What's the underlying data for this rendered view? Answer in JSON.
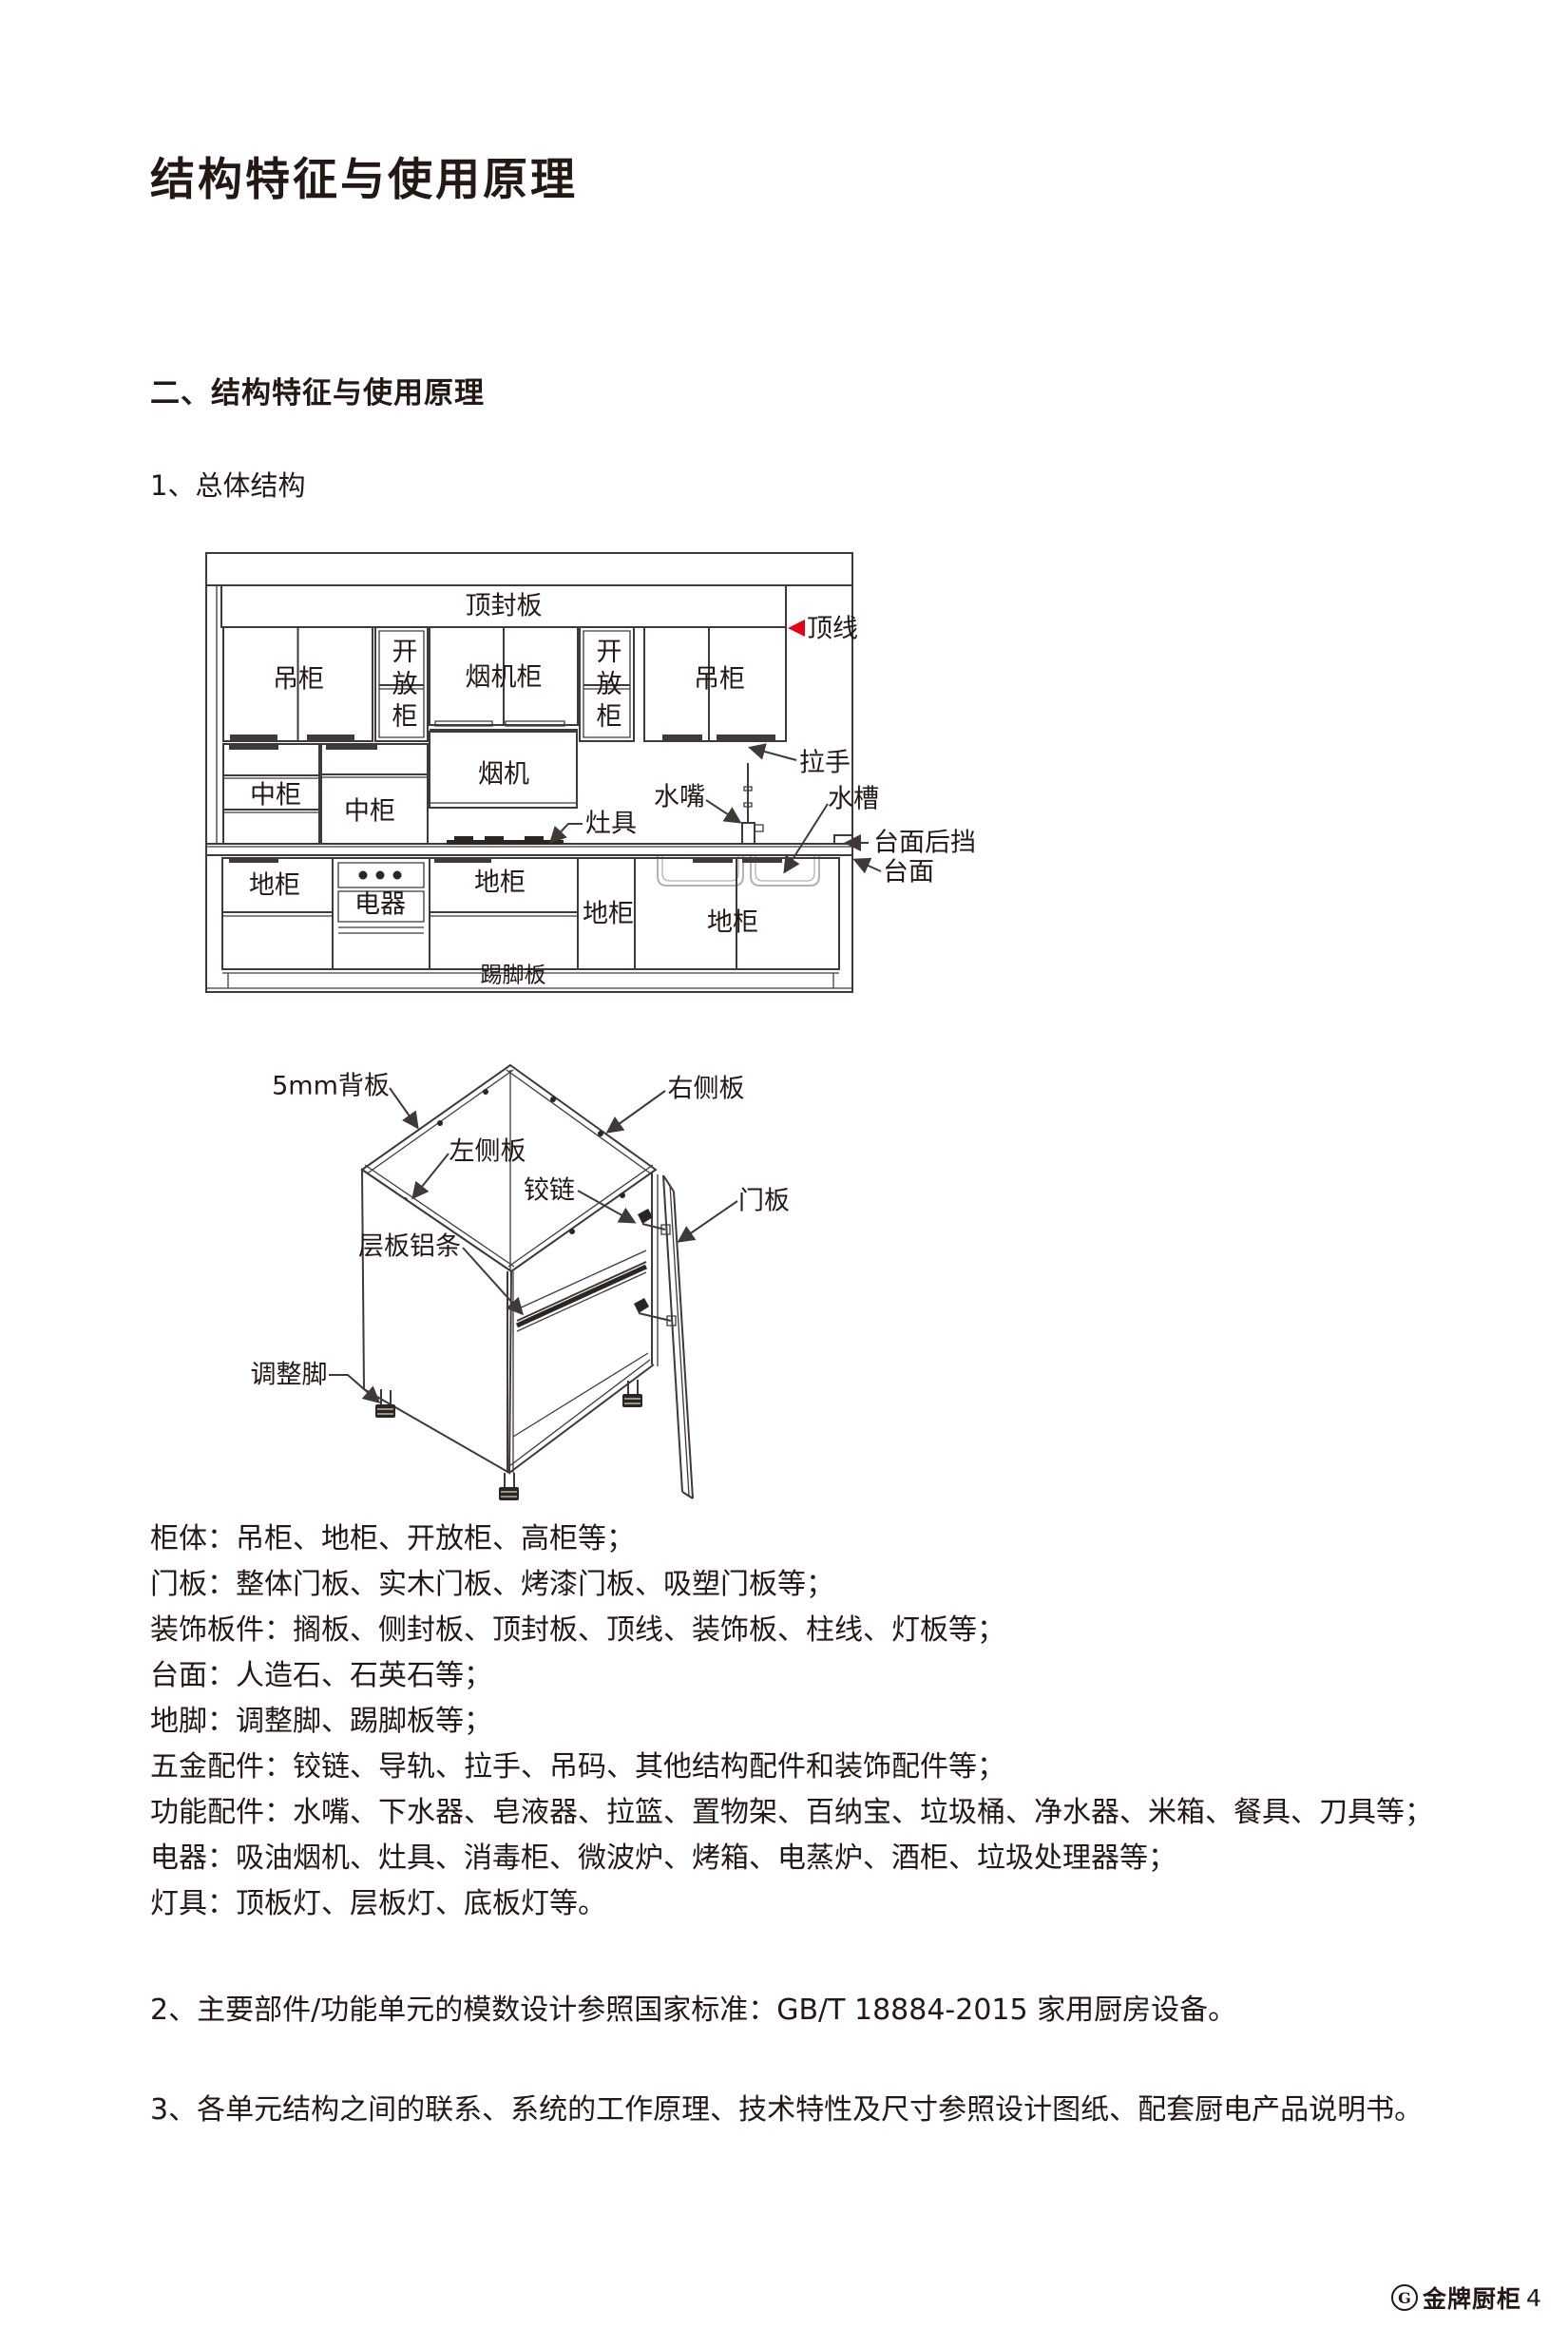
{
  "page": {
    "title": "结构特征与使用原理",
    "section_heading": "二、结构特征与使用原理",
    "subsection_heading": "1、总体结构"
  },
  "diagram_overall": {
    "labels": {
      "top_seal_board": "顶封板",
      "crown_line": "顶线",
      "wall_cabinet": "吊柜",
      "open_cabinet": "开放柜",
      "hood_cabinet": "烟机柜",
      "handle": "拉手",
      "hood": "烟机",
      "mid_cabinet": "中柜",
      "stove": "灶具",
      "faucet": "水嘴",
      "sink": "水槽",
      "countertop_backsplash": "台面后挡",
      "countertop": "台面",
      "base_cabinet": "地柜",
      "appliance": "电器",
      "kick_board": "踢脚板"
    }
  },
  "diagram_unit": {
    "labels": {
      "back_panel": "5mm背板",
      "right_side_panel": "右侧板",
      "left_side_panel": "左侧板",
      "hinge": "铰链",
      "door_panel": "门板",
      "shelf_aluminum_strip": "层板铝条",
      "adjustable_foot": "调整脚"
    }
  },
  "component_list": [
    "柜体：吊柜、地柜、开放柜、高柜等；",
    "门板：整体门板、实木门板、烤漆门板、吸塑门板等；",
    "装饰板件：搁板、侧封板、顶封板、顶线、装饰板、柱线、灯板等；",
    "台面：人造石、石英石等；",
    "地脚：调整脚、踢脚板等；",
    "五金配件：铰链、导轨、拉手、吊码、其他结构配件和装饰配件等；",
    "功能配件：水嘴、下水器、皂液器、拉篮、置物架、百纳宝、垃圾桶、净水器、米箱、餐具、刀具等；",
    "电器：吸油烟机、灶具、消毒柜、微波炉、烤箱、电蒸炉、酒柜、垃圾处理器等；",
    "灯具：顶板灯、层板灯、底板灯等。"
  ],
  "notes": [
    "2、主要部件/功能单元的模数设计参照国家标准：GB/T 18884-2015 家用厨房设备。",
    "3、各单元结构之间的联系、系统的工作原理、技术特性及尺寸参照设计图纸、配套厨电产品说明书。"
  ],
  "footer": {
    "logo_letter": "G",
    "brand": "金牌厨柜",
    "page_number": "4"
  },
  "colors": {
    "text": "#231815",
    "line": "#3f3a37",
    "accent_red": "#e60012",
    "sink_gray": "#b2b2b2"
  }
}
